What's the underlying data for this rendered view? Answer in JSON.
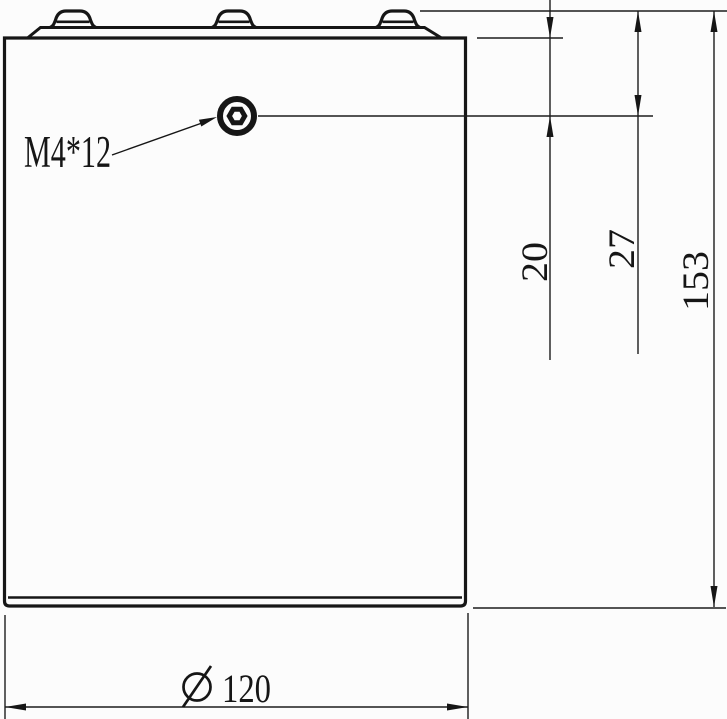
{
  "drawing": {
    "type": "engineering-drawing",
    "subject": "prismatic-cell-side-view",
    "background_color": "#fcfcfc",
    "line_color": "#161616",
    "callout": {
      "screw_label": "M4*12"
    },
    "dimensions": {
      "hole_center_from_case_top": "20",
      "hole_center_from_terminal_top": "27",
      "overall_height": "153",
      "overall_width": "120",
      "diameter_symbol": "Ø"
    },
    "icons": {
      "diameter_symbol_icon": "circle-with-slash",
      "screw_hole_icon": "hex-socket-screw-head"
    }
  }
}
